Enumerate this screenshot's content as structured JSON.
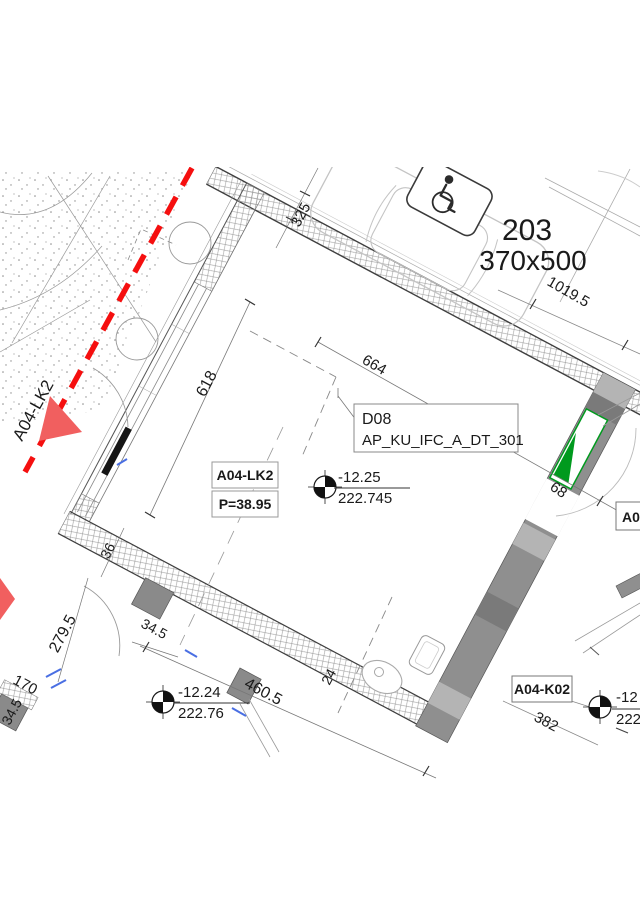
{
  "drawing": {
    "section_label": "A04-LK2",
    "parking_space": {
      "number": "203",
      "size": "370x500"
    },
    "door_tag": {
      "id": "D08",
      "code": "AP_KU_IFC_A_DT_301"
    },
    "room": {
      "tag": "A04-LK2",
      "area": "P=38.95"
    },
    "adjacent_room_tag": "A04",
    "bottom_room_tag": "A04-K02",
    "levels": {
      "room_center": {
        "relative": "-12.25",
        "absolute": "222.745"
      },
      "bottom_left": {
        "relative": "-12.24",
        "absolute": "222.76"
      },
      "bottom_right": {
        "relative": "-12",
        "absolute": "222"
      }
    },
    "dims": {
      "d325": "325",
      "d618": "618",
      "d664": "664",
      "d1019_5": "1019.5",
      "d68": "68",
      "d36": "36",
      "d34_5_left": "34.5",
      "d34_5_mid": "34.5",
      "d279_5": "279.5",
      "d170": "170",
      "d460_5": "460.5",
      "d24": "24",
      "d382": "382"
    },
    "colors": {
      "section_red": "#f50f0f",
      "arrow_red": "#f15f5f",
      "window_green": "#009a1e"
    }
  }
}
